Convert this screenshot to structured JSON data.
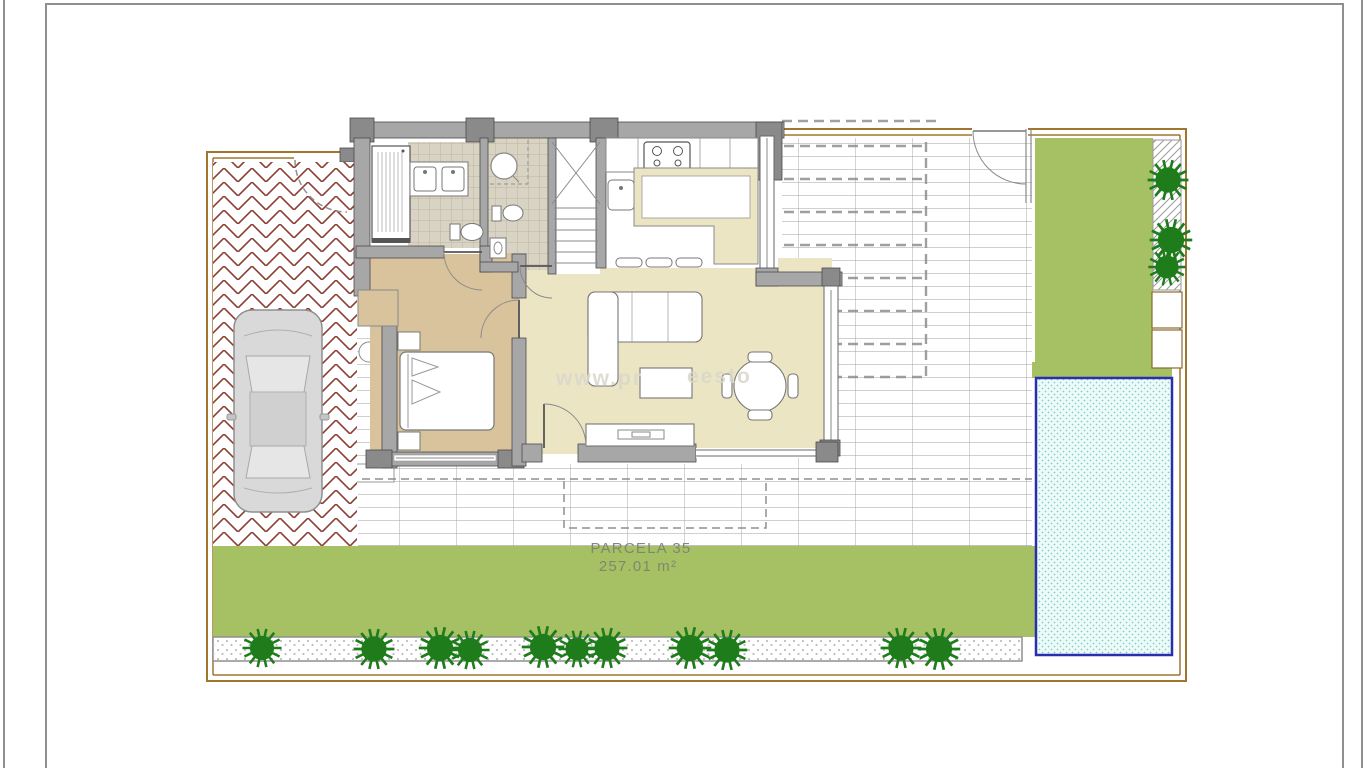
{
  "plan": {
    "parcel_label": "PARCELA 35",
    "parcel_area": "257.01 m²",
    "watermark_fragments": [
      "www.pr",
      "eesto"
    ]
  },
  "colors": {
    "frame_line": "#8f8f8f",
    "boundary": "#a0762f",
    "brick": "#8e3f33",
    "grass": "#a5c163",
    "tree": "#1e7d1a",
    "pool_border": "#2a2fae",
    "pool_water": "#effbf9",
    "pool_dot": "#7fd0c8",
    "wall": "#a7a7a7",
    "wall_dark": "#8a8a8a",
    "wall_edge": "#4a4a4a",
    "floor_living": "#ebe5c4",
    "floor_bedroom": "#d8c39c",
    "tile": "#d9d3c3",
    "tile_line": "#b4ac9b",
    "terrace_line": "#a0a0a0",
    "stipple_dot": "#bdbdbd",
    "furniture_stroke": "#777777",
    "car_body": "#d9d9d9",
    "label_text": "#7f8470",
    "watermark": "#d9d7ca"
  }
}
